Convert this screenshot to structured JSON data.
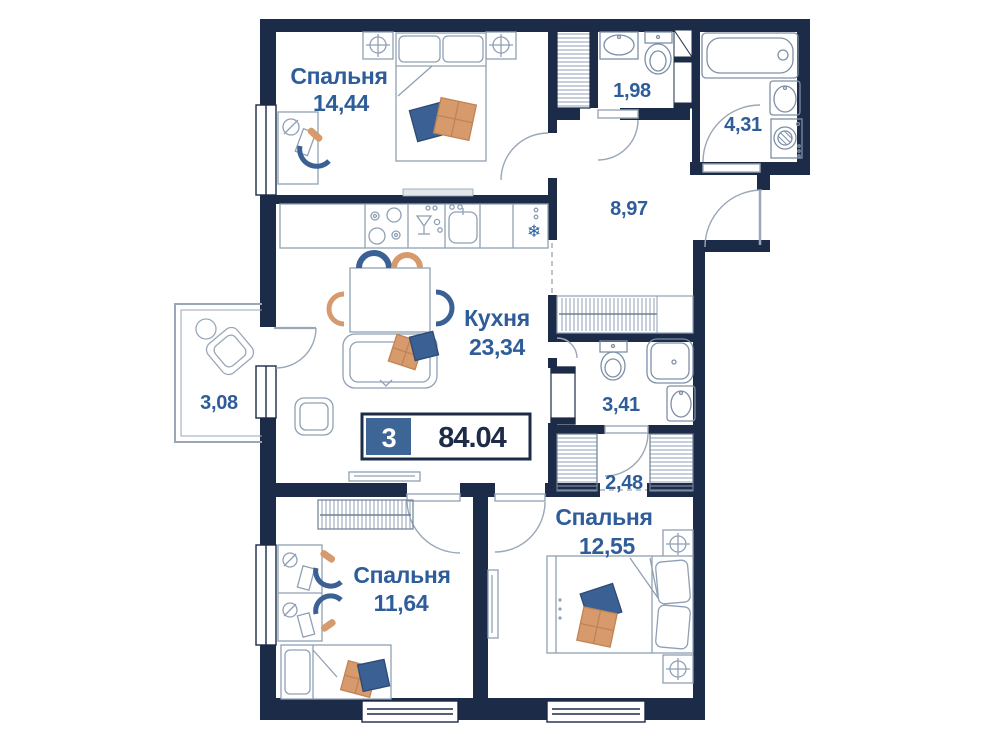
{
  "badge": {
    "rooms_count": "3",
    "total_area": "84.04"
  },
  "rooms": {
    "bedroom_top": {
      "name": "Спальня",
      "area": "14,44"
    },
    "wc": {
      "area": "1,98"
    },
    "bathroom": {
      "area": "4,31"
    },
    "hallway": {
      "area": "8,97"
    },
    "kitchen": {
      "name": "Кухня",
      "area": "23,34"
    },
    "balcony": {
      "area": "3,08"
    },
    "bathroom_small": {
      "area": "3,41"
    },
    "wardrobe_hall": {
      "area": "2,48"
    },
    "bedroom_right": {
      "name": "Спальня",
      "area": "12,55"
    },
    "bedroom_left": {
      "name": "Спальня",
      "area": "11,64"
    }
  },
  "colors": {
    "wall": "#1c2b47",
    "label_blue": "#2e5d99",
    "badge_blue": "#3d6596",
    "pillow_blue": "#3b6094",
    "pillow_orange": "#d69a6d",
    "furniture_line": "#8fa0b4"
  },
  "icons": {
    "fridge": "snowflake-icon",
    "dishwasher": "wine-glass-icon",
    "lamp_marker": "circle-cross-icon"
  }
}
